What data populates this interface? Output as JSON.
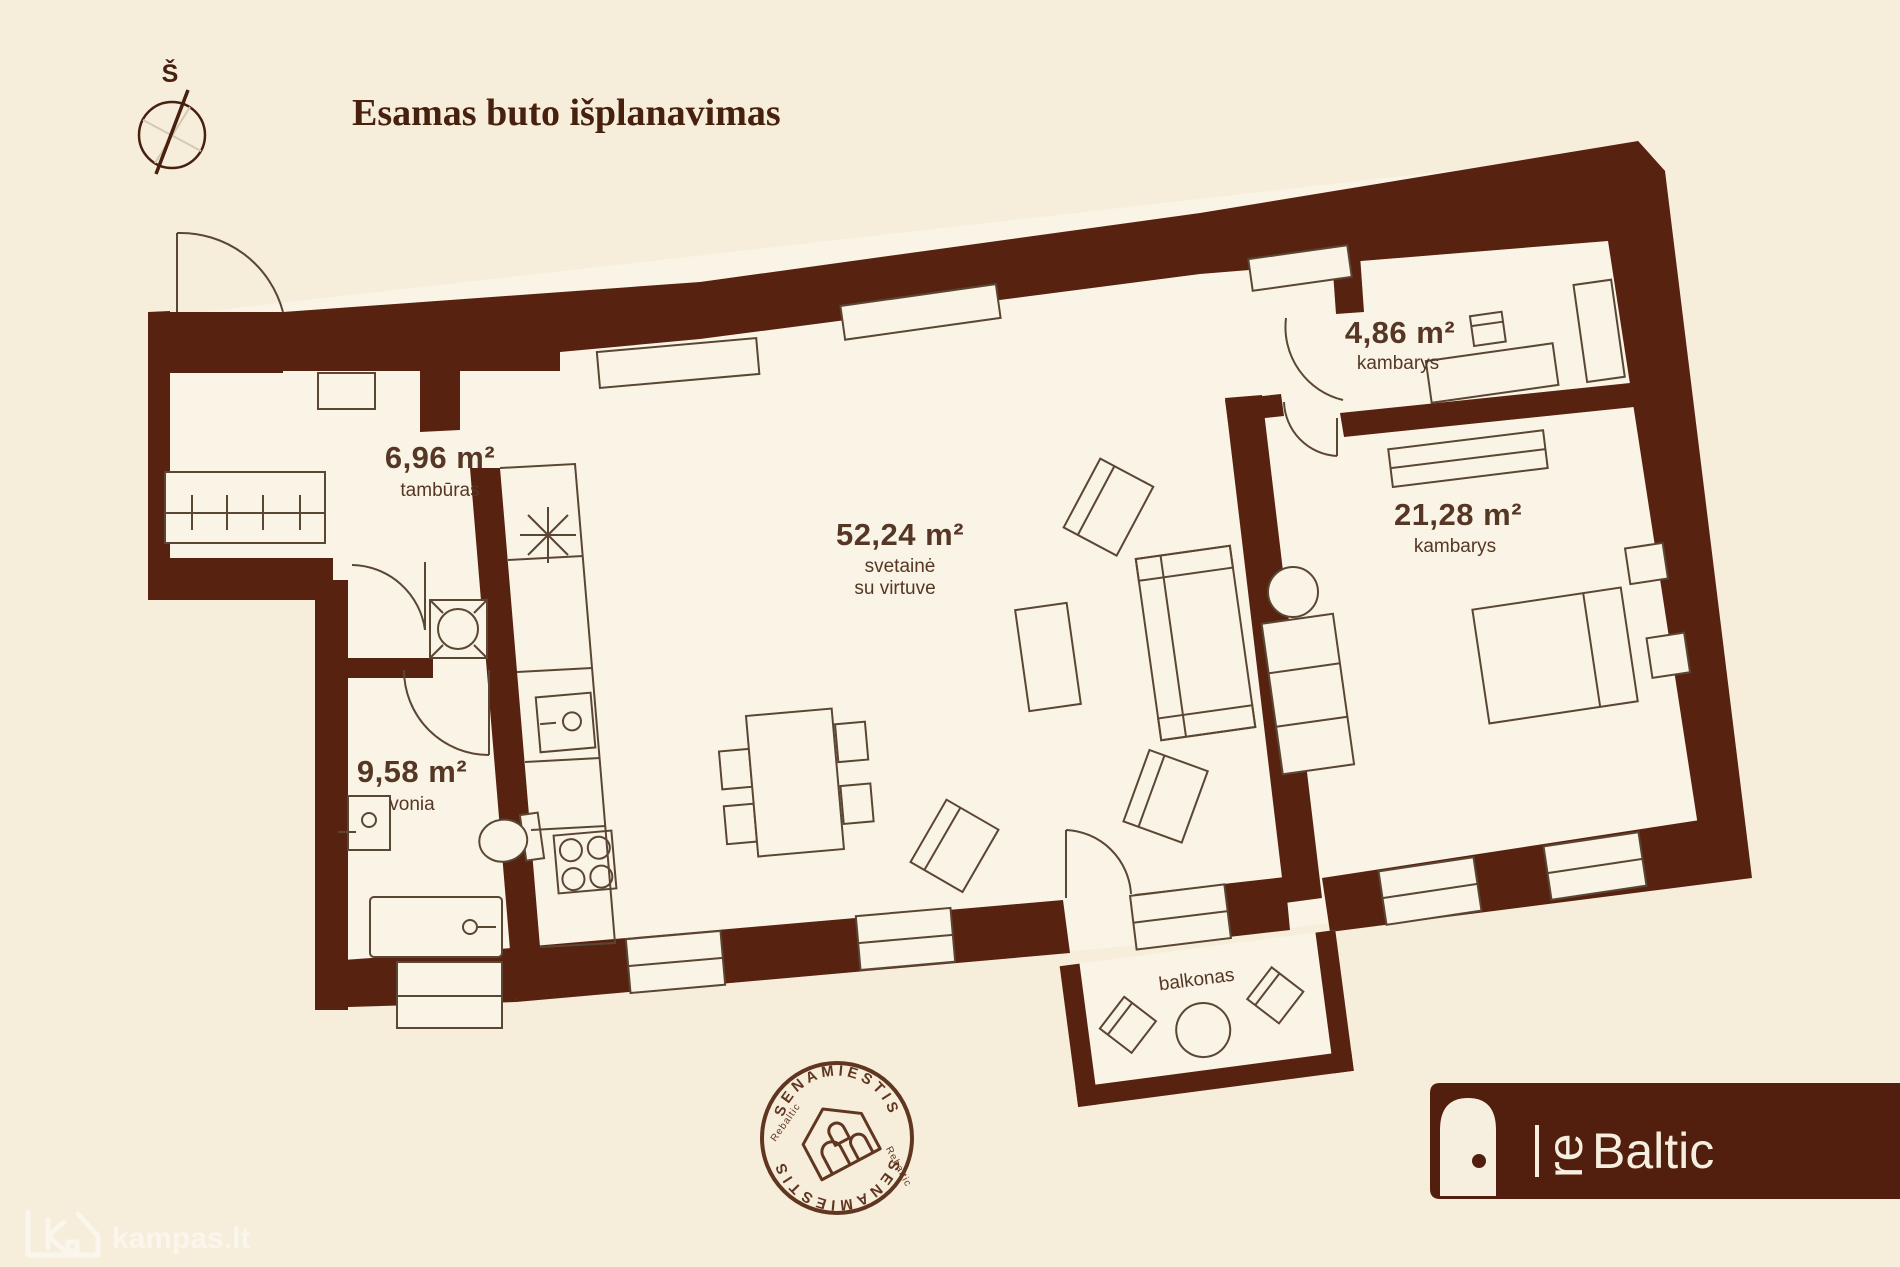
{
  "title": "Esamas buto išplanavimas",
  "compass": {
    "north_label": "Š"
  },
  "rooms": {
    "tamburas": {
      "area": "6,96 m²",
      "name": "tambūras"
    },
    "vonia": {
      "area": "9,58 m²",
      "name": "vonia"
    },
    "svetaine": {
      "area": "52,24 m²",
      "name": "svetainė",
      "name2": "su virtuve"
    },
    "kambarys_small": {
      "area": "4,86 m²",
      "name": "kambarys"
    },
    "kambarys_big": {
      "area": "21,28 m²",
      "name": "kambarys"
    },
    "balkonas": {
      "name": "balkonas"
    }
  },
  "stamp": {
    "top": "SENAMIESTIS",
    "bottom": "SENAMIESTIS",
    "left": "Rebaltic",
    "right": "Rebaltic"
  },
  "logo": {
    "re": "re",
    "baltic": "Baltic"
  },
  "watermark": {
    "text": "kampas.lt"
  },
  "colors": {
    "background": "#f6eedb",
    "room_fill": "#faf4e6",
    "wall": "#572310",
    "furniture_line": "#5b4634",
    "label_text": "#563624",
    "logo_bg": "#521f0e",
    "logo_text": "#f6efdf"
  }
}
